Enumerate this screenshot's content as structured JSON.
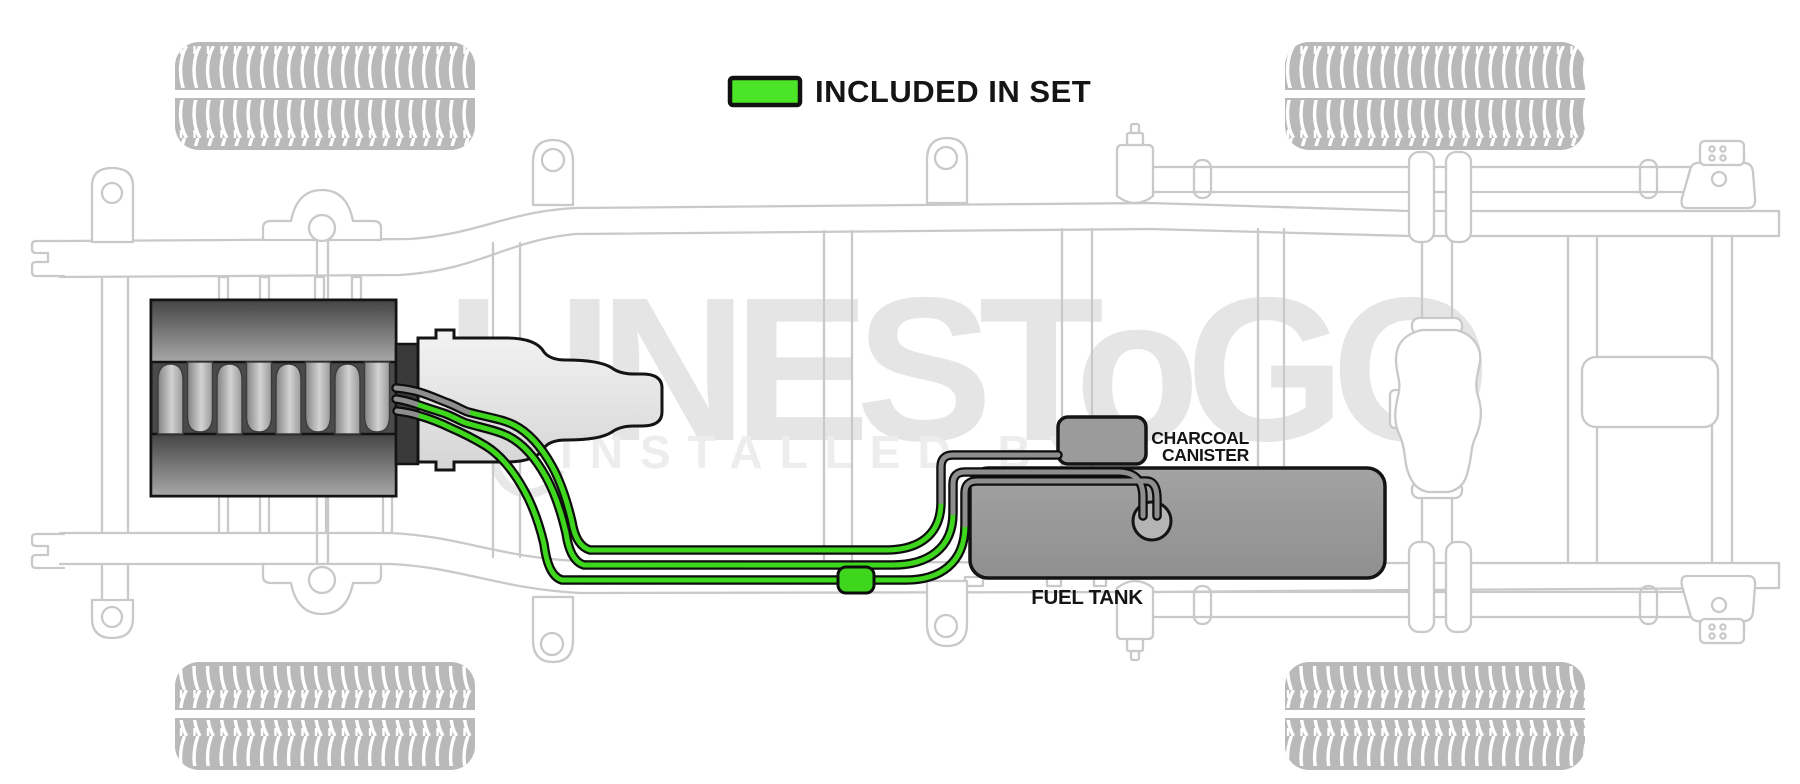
{
  "legend": {
    "label": "INCLUDED IN SET",
    "swatch_icon": "legend-color-swatch"
  },
  "labels": {
    "charcoal_canister_line1": "CHARCOAL",
    "charcoal_canister_line2": "CANISTER",
    "fuel_tank": "FUEL TANK"
  },
  "watermark": {
    "brand": "LINESToGO",
    "tagline": "INSTALLED BY"
  },
  "colors": {
    "legend_green": "#4ce426",
    "line_green": "#3fd61e",
    "line_gray": "#8e8e8e",
    "line_casing": "#0d0d0d",
    "component_gray": "#9b9b9b",
    "chassis_outline": "#c9c9c9",
    "tire_gray": "#b9b9b9",
    "label_black": "#151515"
  },
  "diagram": {
    "type": "fuel-line-routing",
    "view": "truck chassis underbody plan view",
    "legend_meaning": "green colored tubing is included in the set; gray segments are not",
    "fuel_lines": {
      "count": 3,
      "included_color_name": "green",
      "not_included_color_name": "gray",
      "routes": [
        "engine to charcoal canister",
        "engine to fuel tank sender",
        "engine through inline filter to fuel tank sender"
      ]
    },
    "components": [
      "engine block",
      "transmission",
      "fuel tank",
      "charcoal canister",
      "fuel sender unit",
      "inline fuel filter",
      "frame rails",
      "crossmembers",
      "front tires",
      "rear tires",
      "rear axle with differential",
      "leaf springs",
      "spring shackles"
    ]
  }
}
